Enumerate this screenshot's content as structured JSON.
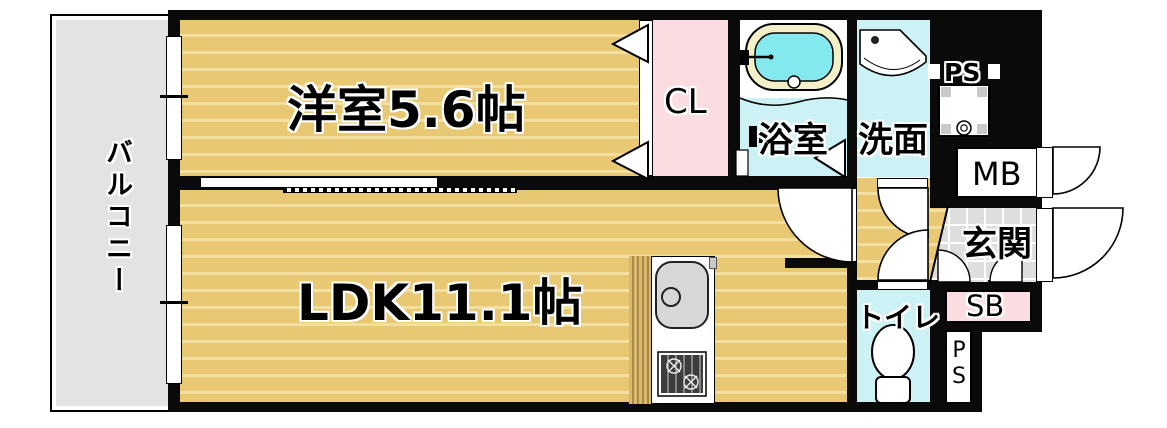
{
  "rooms": {
    "balcony": {
      "label": "バルコニー"
    },
    "western_room": {
      "label": "洋室5.6帖",
      "area_tatami": 5.6
    },
    "ldk": {
      "label": "LDK11.1帖",
      "area_tatami": 11.1
    },
    "closet": {
      "label": "CL"
    },
    "bathroom": {
      "label": "浴室"
    },
    "washroom": {
      "label": "洗面"
    },
    "toilet": {
      "label": "トイレ"
    },
    "entrance": {
      "label": "玄関"
    },
    "meter_box": {
      "label": "MB"
    },
    "shoe_box": {
      "label": "SB"
    },
    "pipe_space_top": {
      "label": "PS"
    },
    "pipe_space_bottom": {
      "label": "PS"
    }
  },
  "fixtures": [
    "bathtub",
    "washbasin",
    "washing-machine-pan",
    "toilet-bowl",
    "kitchen-sink",
    "gas-stove",
    "shower-mixer"
  ],
  "colors": {
    "wall": "#0a0a0a",
    "wood_floor": "#e8c873",
    "wood_stripe": "#f3dfa0",
    "wet_room": "#cdf2f6",
    "closet_pink": "#fbdce0",
    "balcony_gray": "#e3e3e3",
    "entrance_tile": "#dedede",
    "tub_rim": "#f3efc6",
    "tub_water": "#84e9ef"
  }
}
